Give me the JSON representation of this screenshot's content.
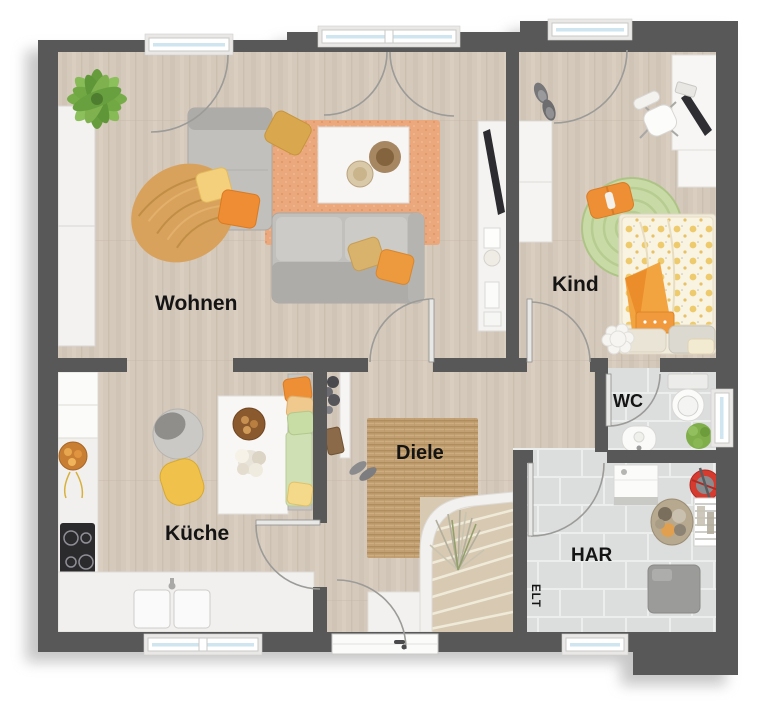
{
  "plan": {
    "type": "floorplan-top-view",
    "rooms": {
      "wohnen": {
        "label": "Wohnen",
        "floor": "wood",
        "furniture": [
          "palm-plant",
          "tall-cabinet",
          "corner-sofa",
          "throw-blanket",
          "pillows",
          "area-rug-orange",
          "coffee-table",
          "tv-sideboard",
          "tv"
        ]
      },
      "kind": {
        "label": "Kind",
        "floor": "wood",
        "furniture": [
          "wardrobe",
          "slippers",
          "desk",
          "monitor",
          "keyboard",
          "office-chair",
          "round-rug-green",
          "bed-polkadot",
          "pillows",
          "flower-pouf"
        ]
      },
      "kueche": {
        "label": "Küche",
        "floor": "wood",
        "furniture": [
          "fridge",
          "counter-left",
          "cooktop",
          "fruit-bowl",
          "counter-sink",
          "dining-table",
          "nut-bowl",
          "flower-deco",
          "chair-gray",
          "chair-yellow",
          "bench-with-cushions"
        ]
      },
      "diele": {
        "label": "Diele",
        "floor": "wood",
        "furniture": [
          "coat-rack",
          "bag",
          "shoes",
          "jute-rug",
          "winder-stairs",
          "dried-grass-plant",
          "entrance-door"
        ]
      },
      "wc": {
        "label": "WC",
        "floor": "tile",
        "furniture": [
          "toilet",
          "hand-basin",
          "plant"
        ]
      },
      "har": {
        "label": "HAR",
        "floor": "tile",
        "furniture": [
          "washing-machine",
          "cleaning-bucket",
          "laundry-basket",
          "drying-rack",
          "utility-unit"
        ]
      },
      "elt": {
        "label": "ELT"
      }
    },
    "colors": {
      "wall": "#585858",
      "wood_floor": "#d5c9bc",
      "tile_floor": "#dcdddd",
      "rug_living": "#eba87d",
      "rug_hall_jute": "#c2a174",
      "rug_kid_green": "#c8daa6",
      "accent_orange": "#ee8d33",
      "accent_yellow": "#f2cf7e",
      "bed_dot_yellow": "#edc75f",
      "bucket_red": "#d63b30",
      "window_glass": "#cfe6f0",
      "stairs_wood": "#d8c9b2"
    }
  }
}
